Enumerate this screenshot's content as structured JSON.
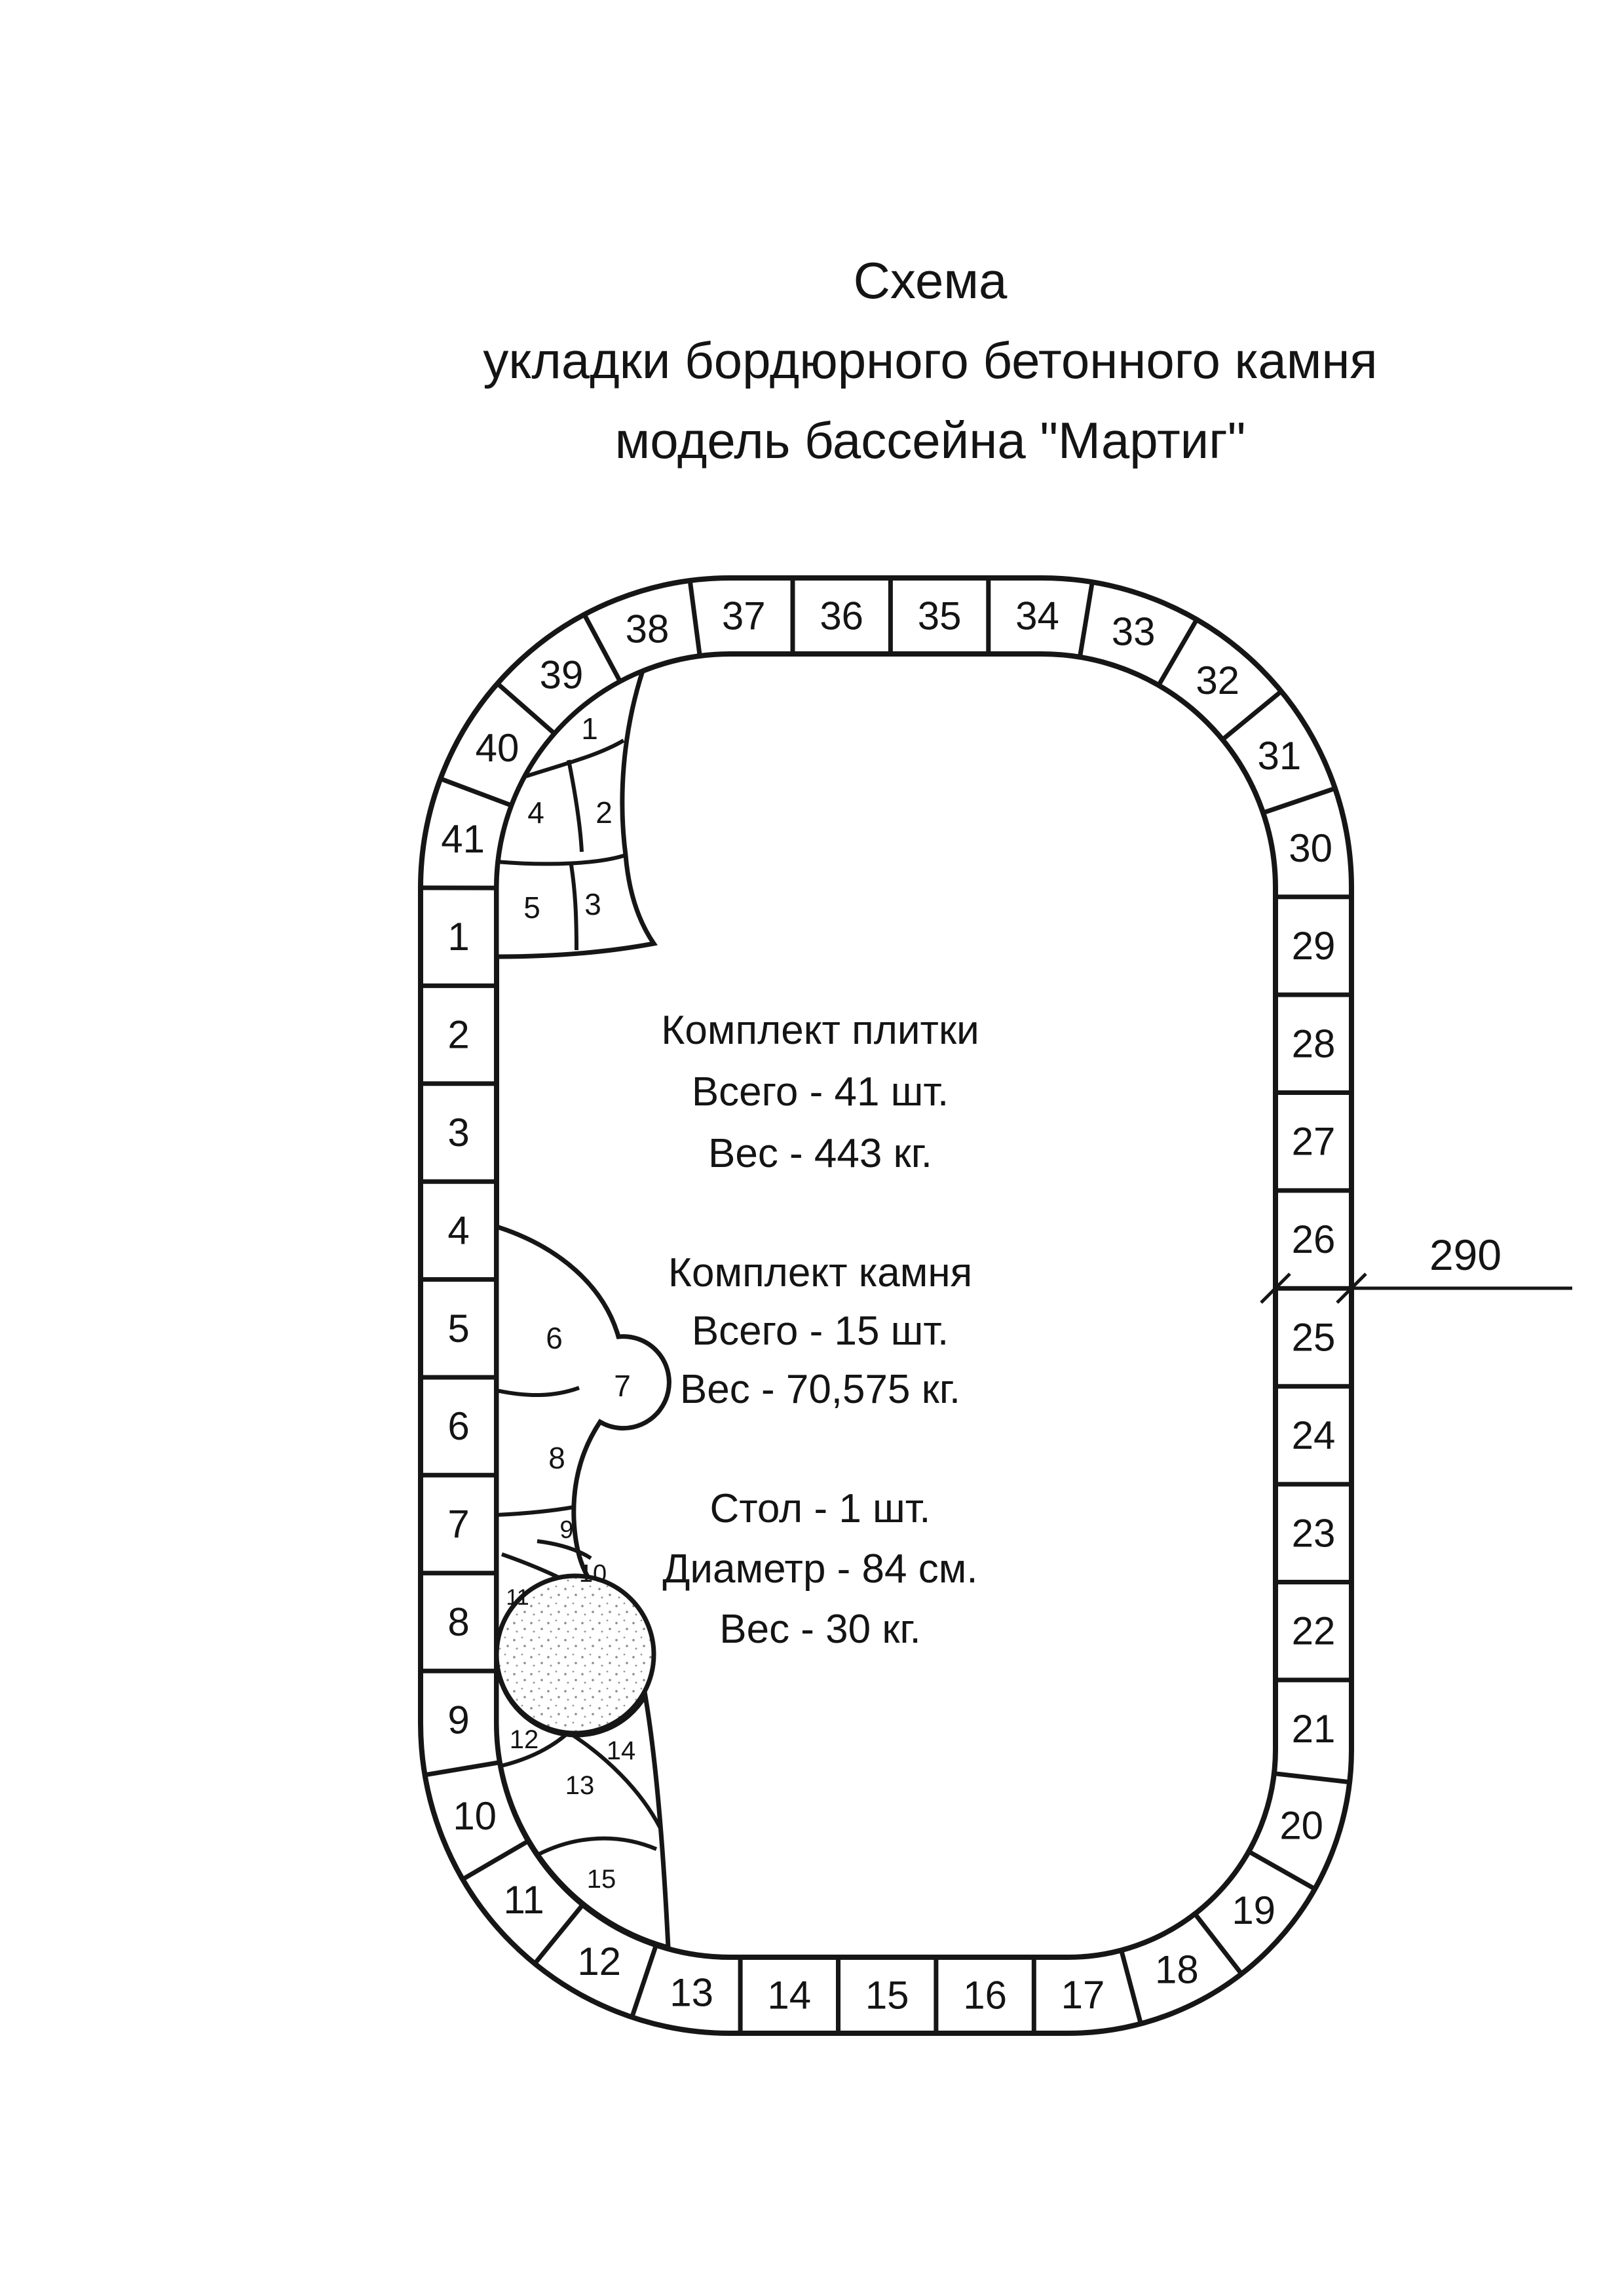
{
  "title": {
    "line1": "Схема",
    "line2": "укладки бордюрного бетонного камня",
    "line3": "модель бассейна \"Мартиг\""
  },
  "info_blocks": [
    {
      "lines": [
        "Комплект плитки",
        "Всего - 41 шт.",
        "Вес - 443  кг."
      ]
    },
    {
      "lines": [
        "Комплект камня",
        "Всего - 15 шт.",
        "Вес - 70,575 кг."
      ]
    },
    {
      "lines": [
        "Стол - 1 шт.",
        "Диаметр - 84 см.",
        "Вес - 30 кг."
      ]
    }
  ],
  "dimension": {
    "label": "290"
  },
  "diagram": {
    "border_tiles": [
      "1",
      "2",
      "3",
      "4",
      "5",
      "6",
      "7",
      "8",
      "9",
      "10",
      "11",
      "12",
      "13",
      "14",
      "15",
      "16",
      "17",
      "18",
      "19",
      "20",
      "21",
      "22",
      "23",
      "24",
      "25",
      "26",
      "27",
      "28",
      "29",
      "30",
      "31",
      "32",
      "33",
      "34",
      "35",
      "36",
      "37",
      "38",
      "39",
      "40",
      "41"
    ],
    "stone_pieces": [
      "1",
      "2",
      "3",
      "4",
      "5",
      "6",
      "7",
      "8",
      "9",
      "10",
      "11",
      "12",
      "13",
      "14",
      "15"
    ],
    "table": {
      "shape": "circle",
      "texture": "stippled"
    }
  },
  "colors": {
    "ink": "#161616",
    "paper": "#ffffff"
  }
}
